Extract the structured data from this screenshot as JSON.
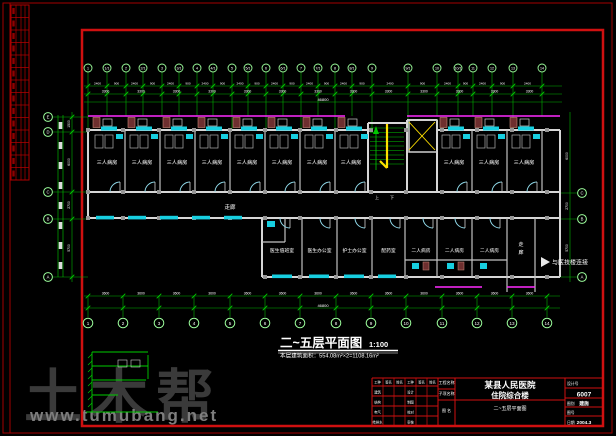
{
  "watermark": {
    "brand": "土木帮",
    "url": "www.tumubang.net"
  },
  "drawing_title": {
    "main": "二~五层平面图",
    "scale": "1:100",
    "area_note": "本层建筑面积：554.08m²×2=1108.16m²"
  },
  "plan": {
    "labels": {
      "ward3": "三人病房",
      "ward2": "二人病房",
      "corridor": "走廊",
      "duty_room": "医生值班室",
      "doctor_office": "医生办公室",
      "nurse_office": "护士办公室",
      "pharmacy": "配药室",
      "up": "上",
      "down": "下",
      "connect_note": "与医技楼连接"
    },
    "axes": {
      "top": [
        "1",
        "1/1",
        "2",
        "2/1",
        "3",
        "3/1",
        "4",
        "4/1",
        "5",
        "5/1",
        "6",
        "6/1",
        "7",
        "7/1",
        "8",
        "8/1",
        "9",
        "9/1",
        "10",
        "10/1",
        "11",
        "12",
        "13",
        "14"
      ],
      "bottom": [
        "1",
        "2",
        "3",
        "4",
        "5",
        "6",
        "7",
        "8",
        "9",
        "10",
        "11",
        "12",
        "13",
        "14"
      ],
      "left": [
        "E",
        "D",
        "C",
        "B",
        "A"
      ],
      "right": [
        "C",
        "B",
        "A"
      ]
    },
    "dims": {
      "small_a": "2400",
      "small_b": "900",
      "bay": "3300",
      "bay_main": "3600",
      "total": "46800",
      "left": [
        "1500",
        "6000",
        "2700",
        "5700"
      ],
      "right": [
        "6000",
        "2700",
        "5700"
      ]
    }
  },
  "titleblock": {
    "labels": {
      "project": "工程名称",
      "subproject": "子项名称",
      "drawing": "图 名"
    },
    "project_name_line1": "某县人民医院",
    "project_name_line2": "住院综合楼",
    "drawing_name": "二~五层平面图",
    "design_no": "6007",
    "left_table": {
      "headers": [
        "工种",
        "签名",
        "姓名",
        "工种",
        "签名",
        "姓名"
      ],
      "rows": [
        [
          "建筑",
          "",
          "",
          "设计",
          "",
          ""
        ],
        [
          "结构",
          "",
          "",
          "制图",
          "",
          ""
        ],
        [
          "电气",
          "",
          "",
          "校对",
          "",
          ""
        ],
        [
          "给排水",
          "",
          "",
          "审核",
          "",
          ""
        ]
      ]
    },
    "right_rows": [
      {
        "label": "设计号",
        "value": ""
      },
      {
        "label": "",
        "value": "6007"
      },
      {
        "label": "图别",
        "value": "建施"
      },
      {
        "label": "图号",
        "value": ""
      },
      {
        "label": "日期",
        "value": "2004.3"
      }
    ]
  }
}
